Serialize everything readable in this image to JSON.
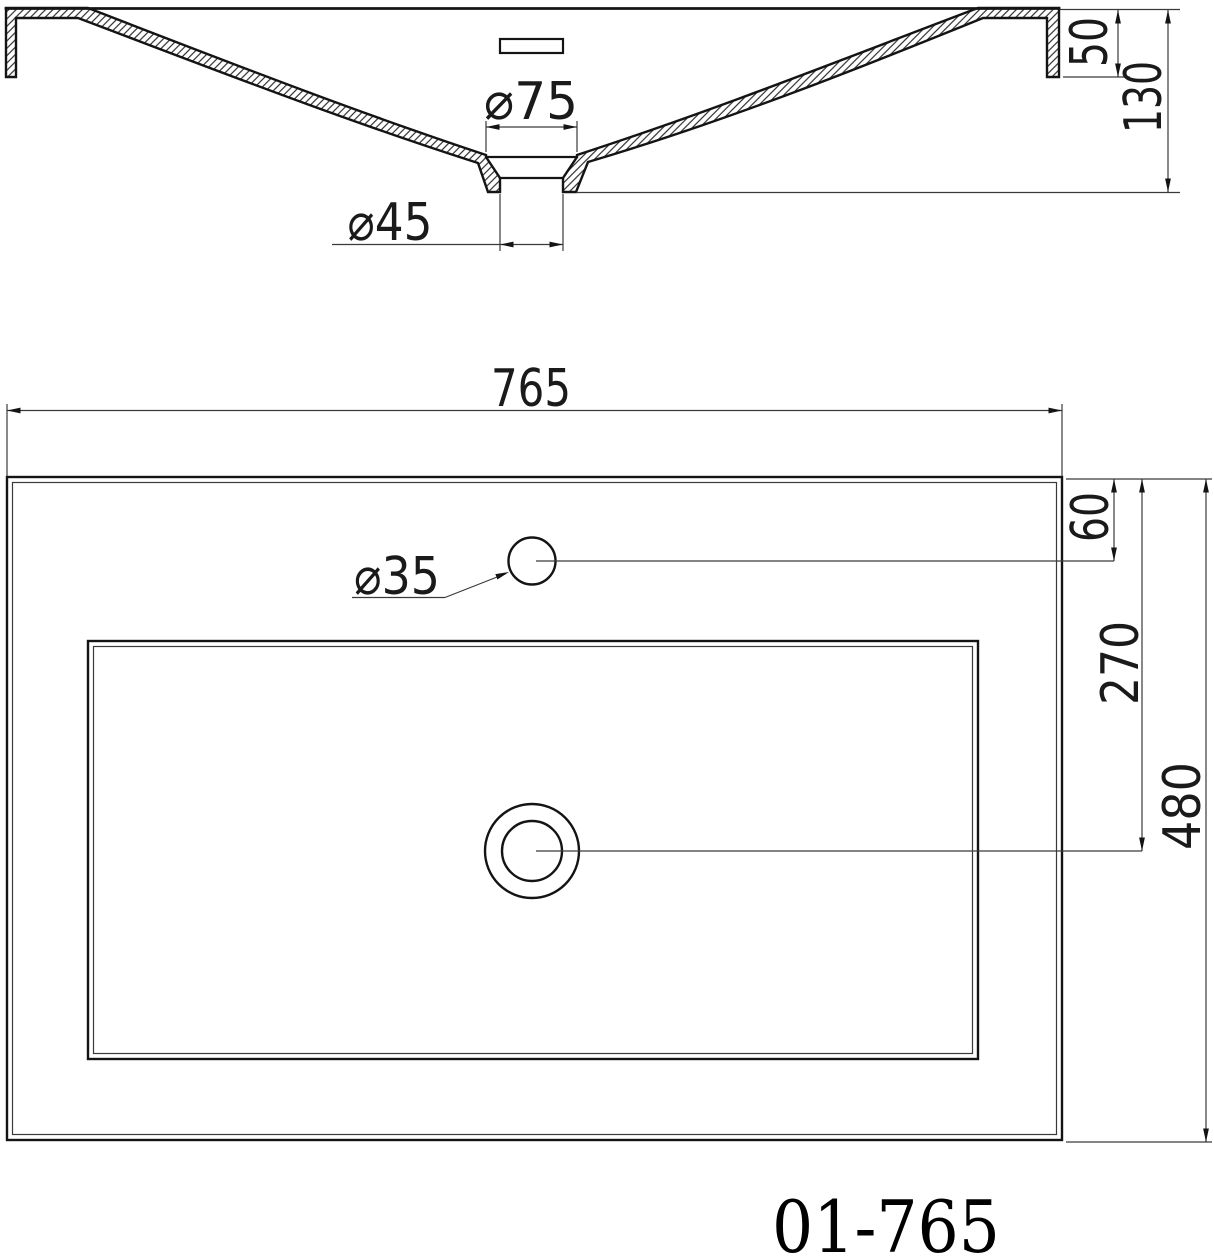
{
  "colors": {
    "line": "#141414",
    "dimension_line": "#3a3a3a",
    "background": "#ffffff"
  },
  "section_view": {
    "dim_drain_flange_dia": "⌀75",
    "dim_drain_outlet_dia": "⌀45",
    "dim_rim_height": "50",
    "dim_overall_height": "130"
  },
  "plan_view": {
    "dim_overall_width": "765",
    "dim_faucet_hole_dia": "⌀35",
    "dim_faucet_hole_offset": "60",
    "dim_drain_center_offset": "270",
    "dim_overall_depth": "480"
  },
  "title_block": {
    "model_number": "01-765"
  }
}
